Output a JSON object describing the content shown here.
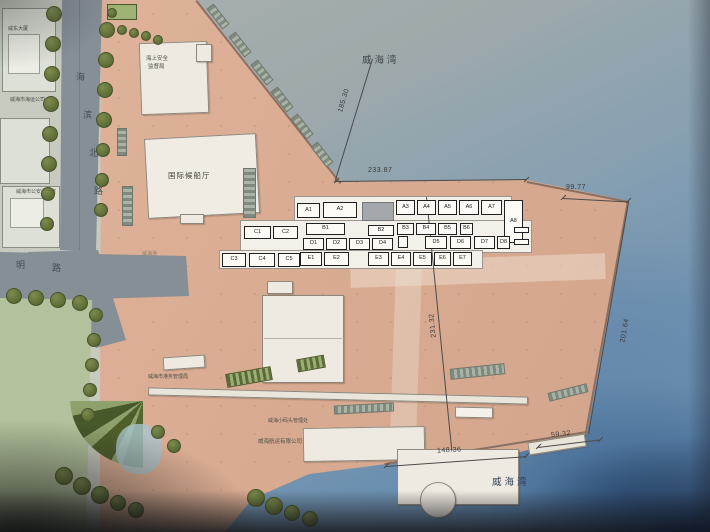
{
  "labels": {
    "bay_top": "威海湾",
    "bay_bottom": "威海湾",
    "port_apron": "威海港"
  },
  "roads": {
    "vertical": [
      "海",
      "滨",
      "北",
      "路"
    ],
    "horizontal": [
      "明",
      "路"
    ]
  },
  "buildings": {
    "weidong": "威东大厦",
    "marine_co": "威海市海运公司",
    "gov_office": "威海市公安办公室",
    "msa_line1": "海上安全",
    "msa_line2": "监督局",
    "terminal": "国际候船厅",
    "port_authority": "威海市港务管理局",
    "small_dock": "威海小码头管理处",
    "shipping_co": "威海航运有限公司"
  },
  "dimensions": {
    "d185": "185.30",
    "d233": "233.87",
    "d99": "99.77",
    "d231": "231.32",
    "d201": "201.64",
    "d148": "148.36",
    "d59": "59.32"
  },
  "berth_rows": {
    "row_a": [
      "A1",
      "A2",
      "A3",
      "A4",
      "A5",
      "A6",
      "A7"
    ],
    "row_a_vertical": "A8",
    "row_b": [
      "C1",
      "C2",
      "B1",
      "B2",
      "B3",
      "B4",
      "B5",
      "B6"
    ],
    "row_d": [
      "D1",
      "D2",
      "D3",
      "D4",
      "D5",
      "D6",
      "D7",
      "D8"
    ],
    "row_e": [
      "C3",
      "C4",
      "C5",
      "E1",
      "E2",
      "E3",
      "E4",
      "E5",
      "E6",
      "E7"
    ]
  },
  "colors": {
    "water_shallow": "#a9b0ae",
    "water_deep": "#5d82a8",
    "port_land": "#d9ab92",
    "lawn": "#b3c29c",
    "road": "#868e96",
    "tree": "#69773f"
  }
}
